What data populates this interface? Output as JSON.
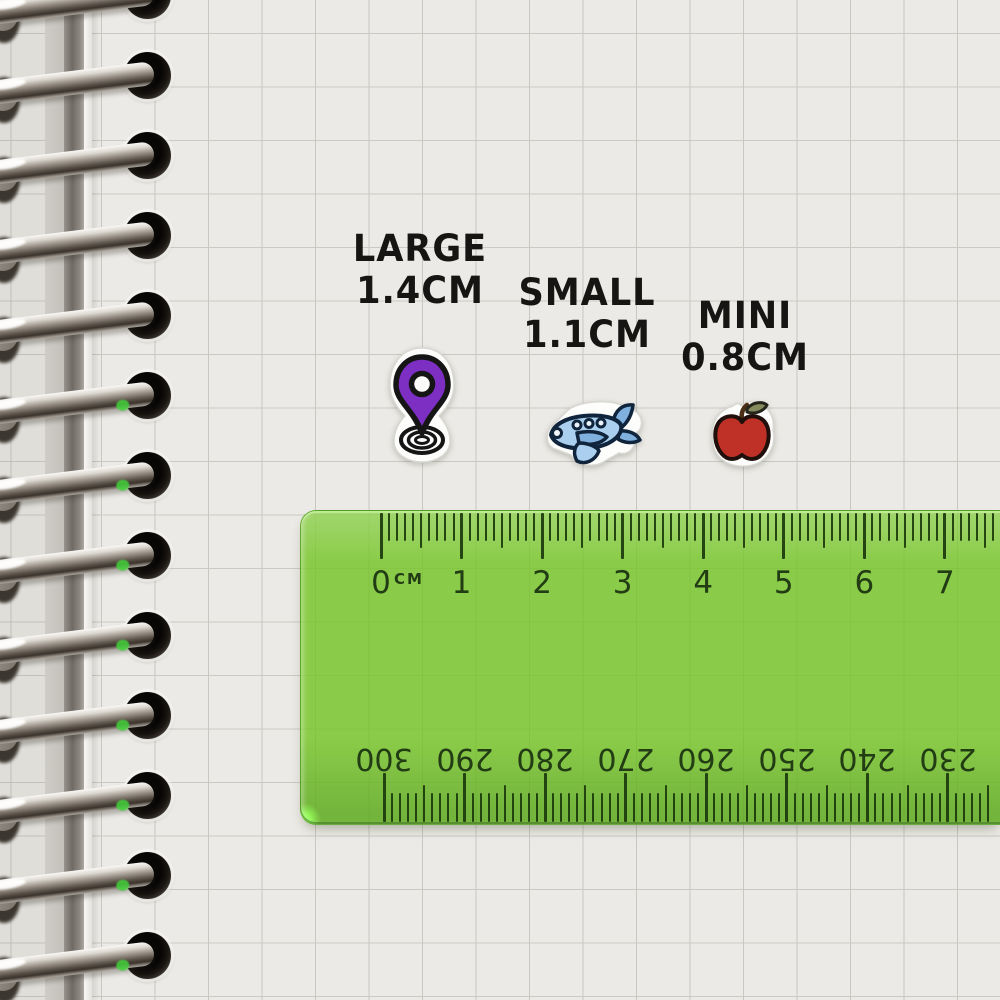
{
  "sticker_groups": [
    {
      "label": "LARGE",
      "size": "1.4CM",
      "icon": "location-pin"
    },
    {
      "label": "SMALL",
      "size": "1.1CM",
      "icon": "airplane"
    },
    {
      "label": "MINI",
      "size": "0.8CM",
      "icon": "apple"
    }
  ],
  "ruler": {
    "unit": "CM",
    "cm_labels": [
      "0",
      "1",
      "2",
      "3",
      "4",
      "5",
      "6",
      "7"
    ],
    "reverse_mm_labels": [
      "300",
      "290",
      "280",
      "270",
      "260",
      "250",
      "240",
      "230"
    ]
  },
  "colors": {
    "ruler_green": "#7cc32b",
    "pin_purple": "#7d2fc4",
    "plane_blue": "#abd0ef",
    "plane_blue_dark": "#7fb0de",
    "plane_window": "#e8f3fb",
    "apple_red": "#bf3127",
    "leaf_olive": "#868b5e",
    "stem_brown": "#4a2e16",
    "ink_black": "#171513",
    "tick_ink": "#1b3a0c"
  }
}
